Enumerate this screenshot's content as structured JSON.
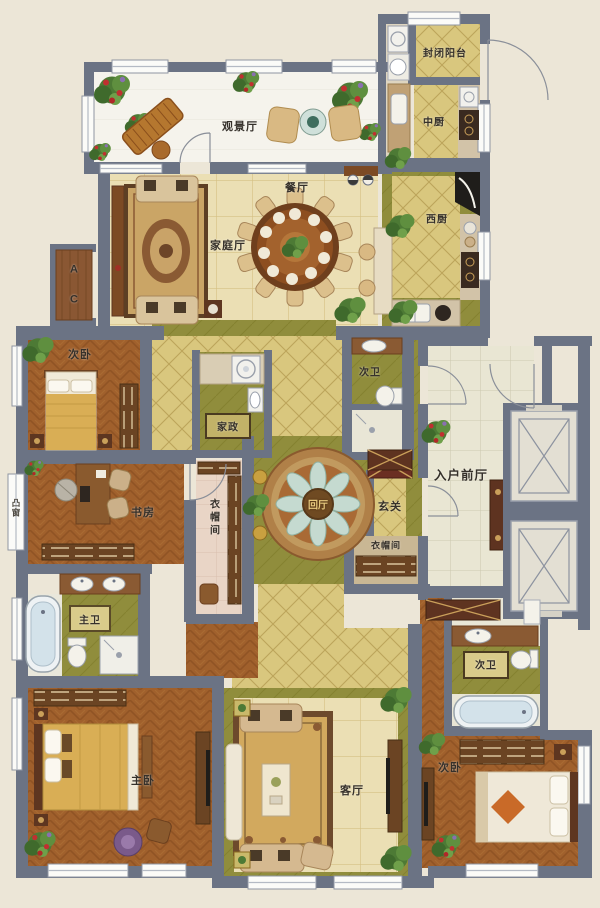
{
  "palette": {
    "background": "#ece6d7",
    "wall": "#6b7384",
    "wood_floor": "#a0602c",
    "tile_beige": "#ebdfb4",
    "tile_khaki": "#d9c77e",
    "olive": "#908d3c",
    "foyer_tile": "#e9e6d3",
    "closet_pink": "#e9d5c6",
    "viewing_floor": "#f5f3ec",
    "rug_gold": "#d2a95e",
    "accent_gold": "#c9a040",
    "plant_green": "#4d7a35",
    "flower_red": "#c03030",
    "water_blue": "#cfe0ea",
    "dark_wood": "#5e3620"
  },
  "labels": {
    "viewing_hall": "观景厅",
    "enclosed_balcony": "封闭阳台",
    "chinese_kitchen": "中厨",
    "western_kitchen": "西厨",
    "dining_room": "餐厅",
    "family_hall": "家庭厅",
    "ac": "A C",
    "bedroom_second_top": "次卧",
    "housekeeping": "家政",
    "second_bath_mid": "次卫",
    "entrance_foyer": "入户前厅",
    "rotunda_hall": "回厅",
    "entryway": "玄关",
    "cloakroom_entry": "衣帽间",
    "study": "书房",
    "bay_window": "凸窗",
    "walkin_closet": "衣帽间",
    "master_bath": "主卫",
    "master_bedroom": "主卧",
    "living_room": "客厅",
    "bedroom_second_bottom": "次卧",
    "second_bath_bottom": "次卫"
  }
}
